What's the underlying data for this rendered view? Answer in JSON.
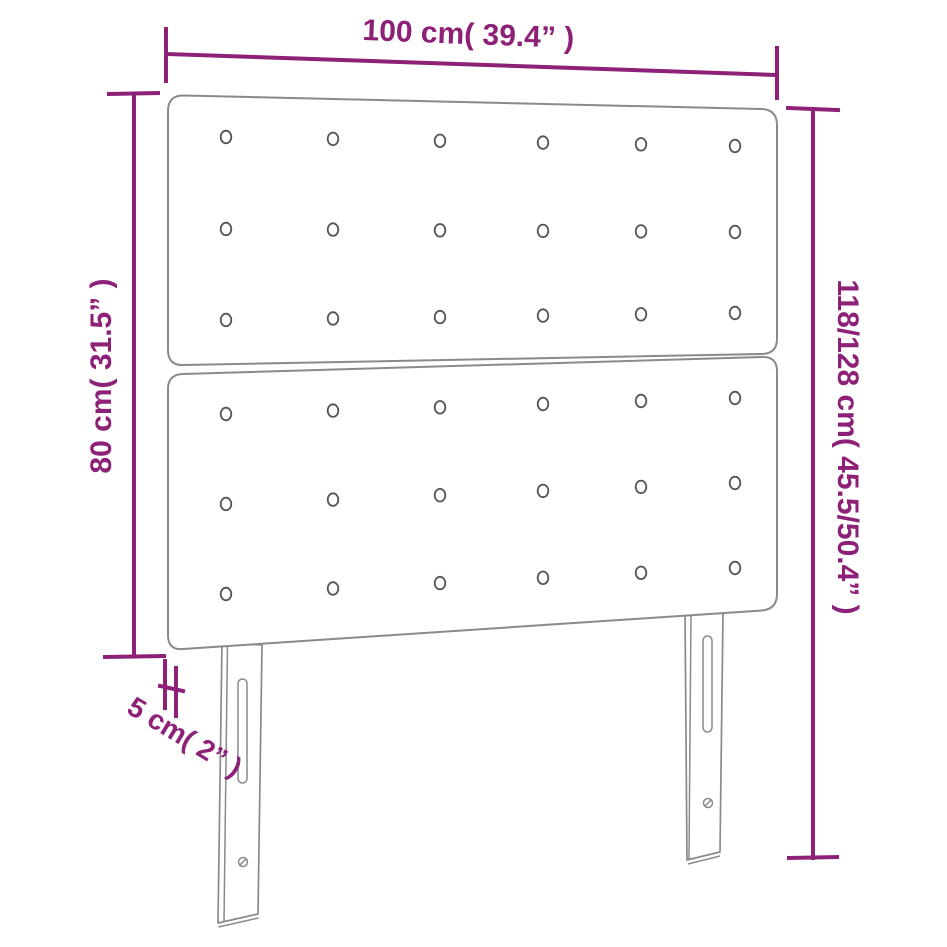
{
  "colors": {
    "background": "#FFFFFF",
    "accent": "#8D2077",
    "outline": "#8A8A8A",
    "button": "#555555"
  },
  "dimensions": {
    "width": {
      "label": "100 cm( 39.4” )"
    },
    "panel_height": {
      "label": "80 cm( 31.5” )"
    },
    "total_height": {
      "label": "118/128 cm( 45.5/50.4” )"
    },
    "thickness": {
      "label": "5 cm( 2” )"
    }
  },
  "product": {
    "type": "headboard",
    "panel_count": 2,
    "tufting_buttons": {
      "rows_per_panel": 3,
      "columns": 6
    },
    "leg_count": 2
  }
}
